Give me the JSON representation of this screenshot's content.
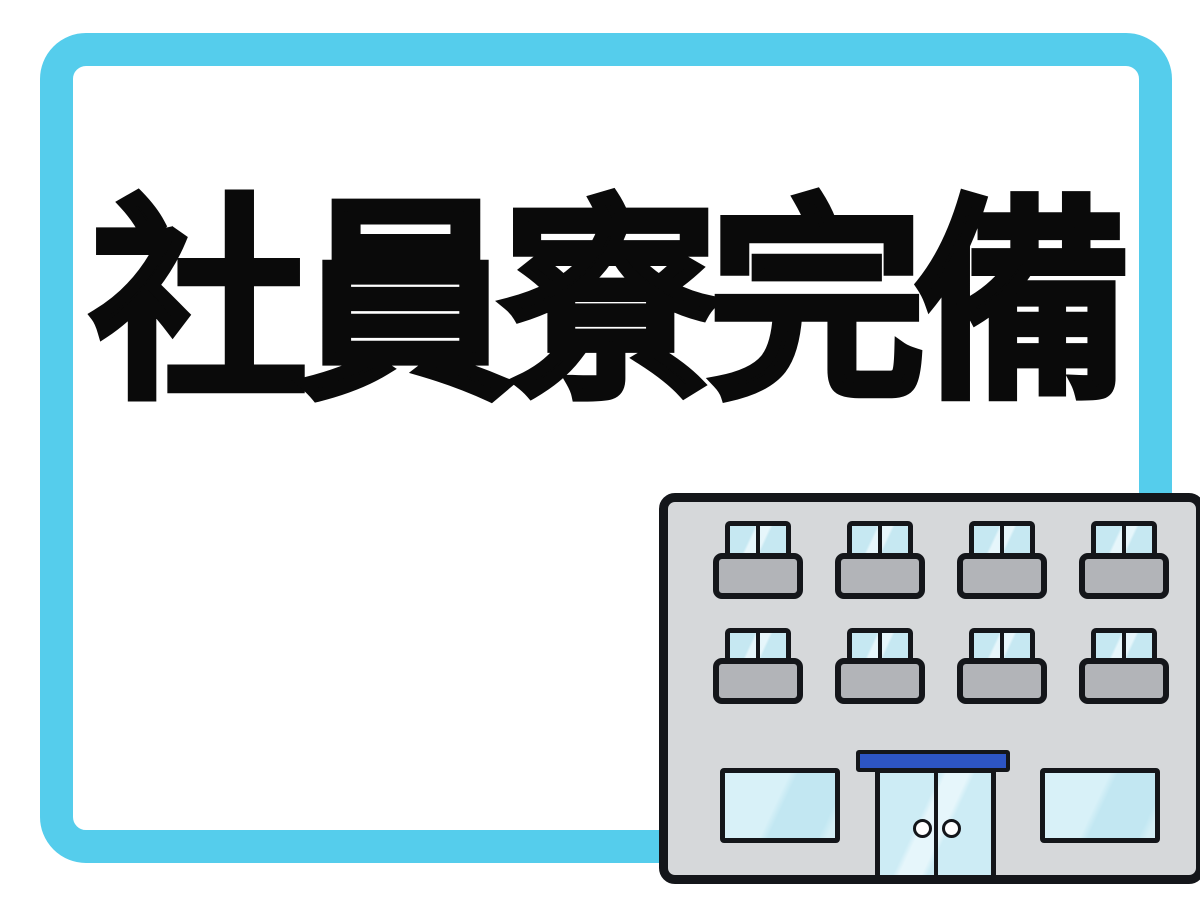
{
  "page": {
    "background_color": "#FFFFFF",
    "frame_color": "#55CDEC",
    "card_color": "#FFFFFF"
  },
  "headline": {
    "text": "社員寮完備",
    "color": "#0A0A0A"
  },
  "illustration": {
    "name": "dormitory-building-icon",
    "wall_color": "#D6D8DA",
    "outline_color": "#14161A",
    "balcony_color": "#B2B4B8",
    "glass_color": "#C6E8F2",
    "glass_highlight_color": "#E6F6FB",
    "awning_color": "#2D55C4",
    "door_handle_color": "#FFFFFF",
    "floors_with_balconies": 2,
    "units_per_floor": 4,
    "ground_floor_windows": 2,
    "door_handles": 2
  }
}
